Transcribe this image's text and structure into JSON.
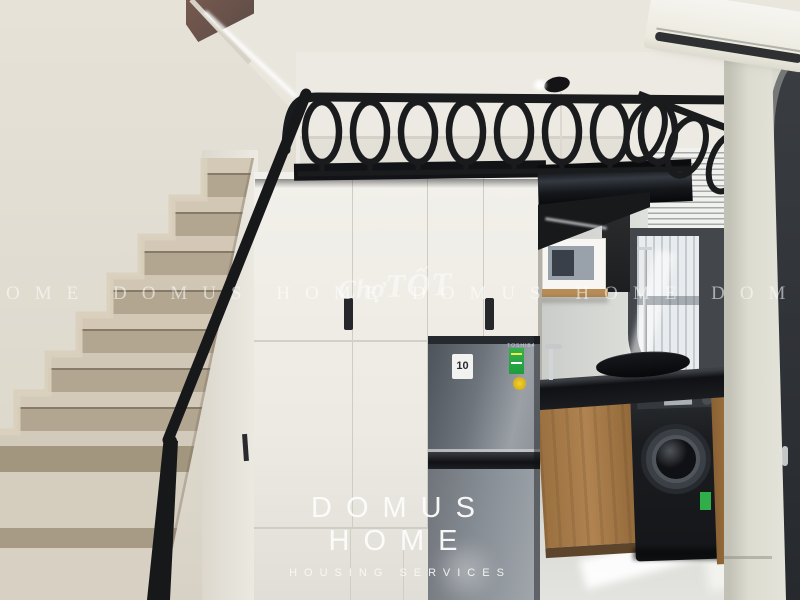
{
  "watermarks": {
    "band_text": "OME DOMUS HOME DOMUS HOME DOMUS H",
    "marketplace_script": "Chợ",
    "marketplace_caps": "TỐT",
    "logo_title": "DOMUS HOME",
    "logo_subtitle": "HOUSING SERVICES"
  },
  "appliances": {
    "fridge_brand": "TOSHIBA",
    "fridge_inverter_badge": "10"
  },
  "colors": {
    "ceiling": "#e9e6de",
    "wall": "#e3dfd5",
    "stair_wood": "#c7bba7",
    "metal_black": "#17181a",
    "cabinet_white": "#f0eee8",
    "fridge_gray": "#7c828a",
    "counter_black": "#141518",
    "kitchen_wood": "#a87c4a",
    "floor": "#d6d6d2",
    "watermark_white": "#ffffff"
  }
}
